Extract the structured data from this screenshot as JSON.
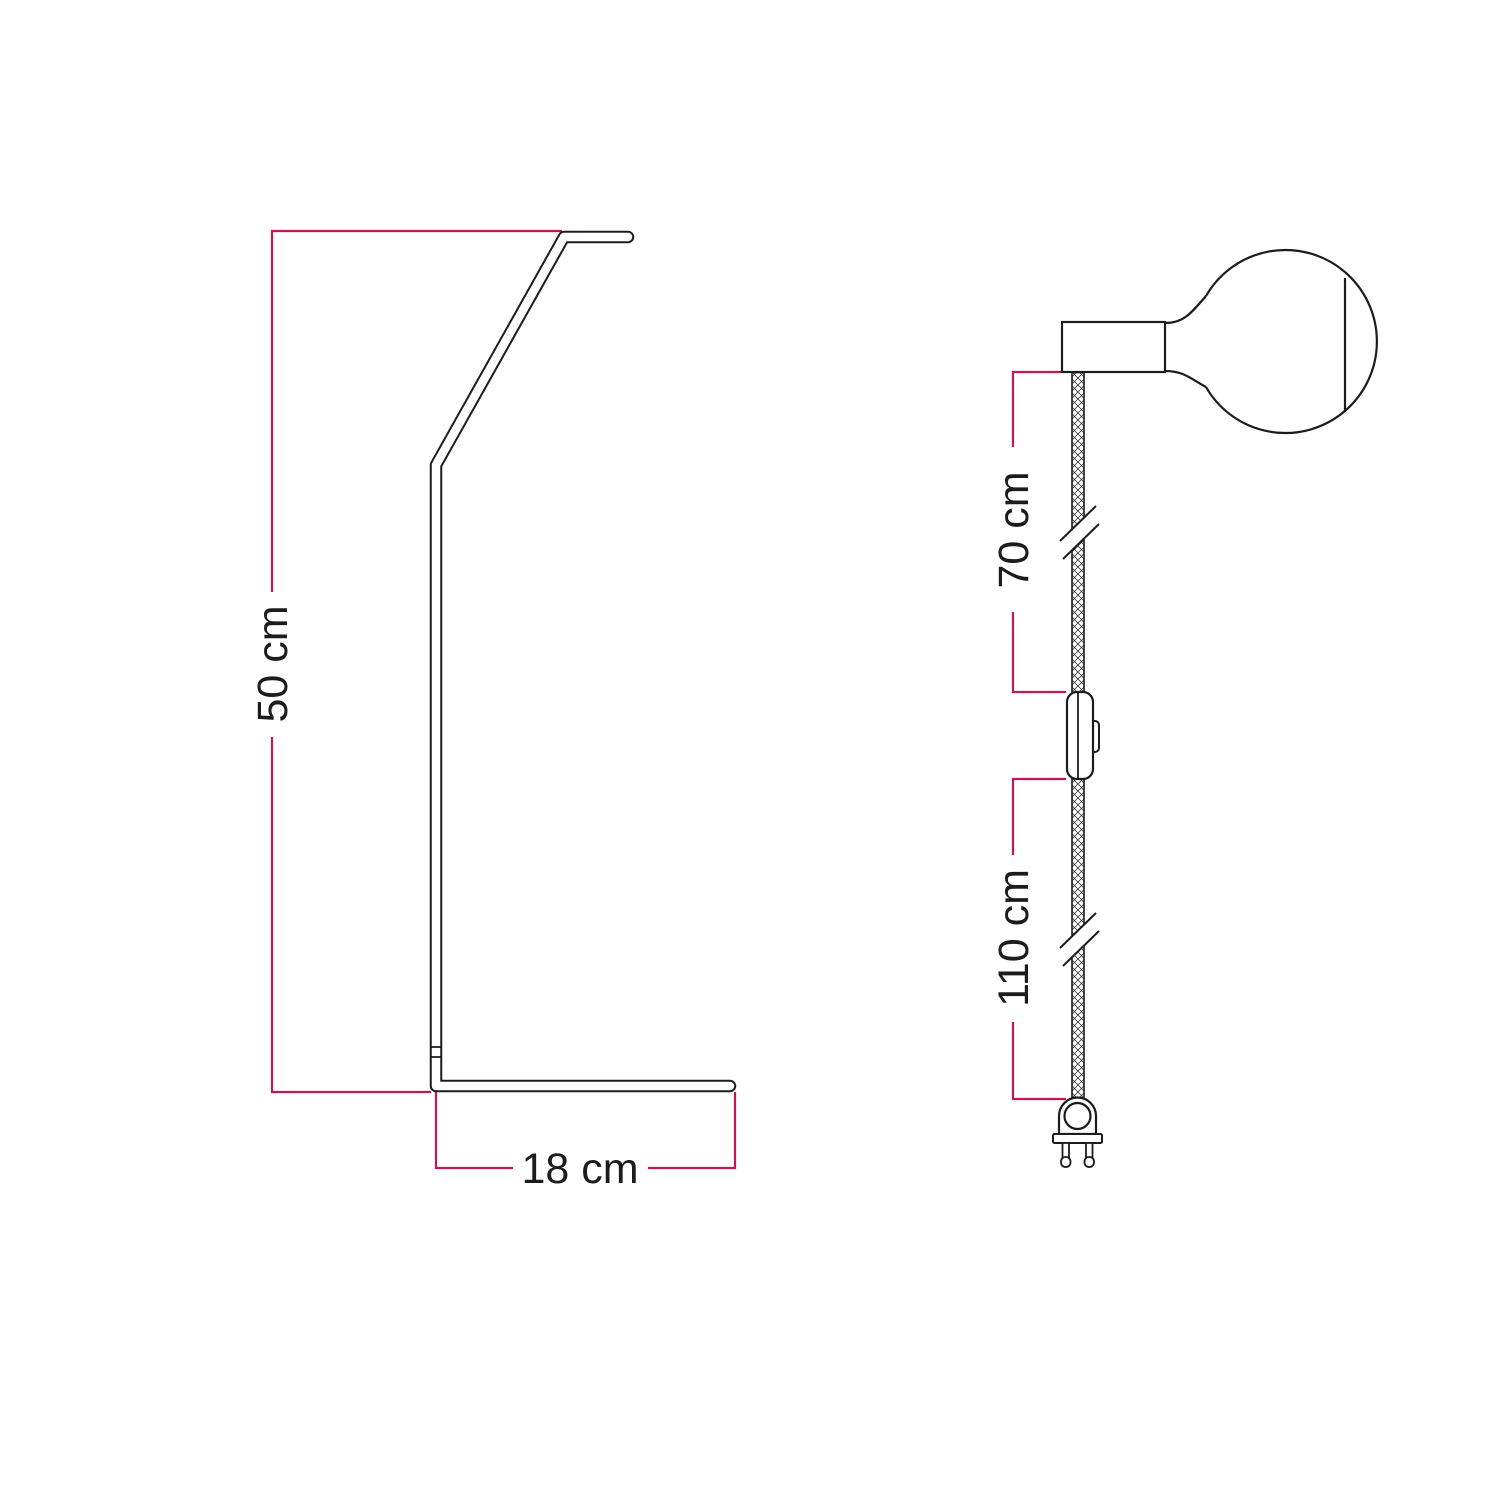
{
  "colors": {
    "dimension_line": "#c2185b",
    "drawing_outline": "#1c1c1c",
    "background": "#ffffff"
  },
  "stand_figure": {
    "height_label": "50 cm",
    "base_label": "18 cm"
  },
  "cable_figure": {
    "socket_to_switch_label": "70 cm",
    "switch_to_plug_label": "110 cm"
  }
}
